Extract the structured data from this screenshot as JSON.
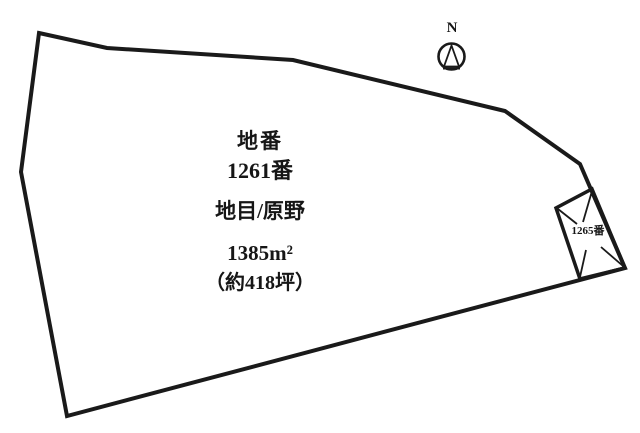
{
  "diagram": {
    "main_parcel": {
      "title": "地番",
      "lot_number": "1261番",
      "land_category": "地目/原野",
      "area_sqm": "1385m²",
      "area_tsubo": "（約418坪）"
    },
    "adjacent_parcel": {
      "lot_number": "1265番"
    },
    "compass": {
      "label": "N"
    },
    "colors": {
      "line": "#1a1a1a",
      "background": "#ffffff"
    }
  }
}
